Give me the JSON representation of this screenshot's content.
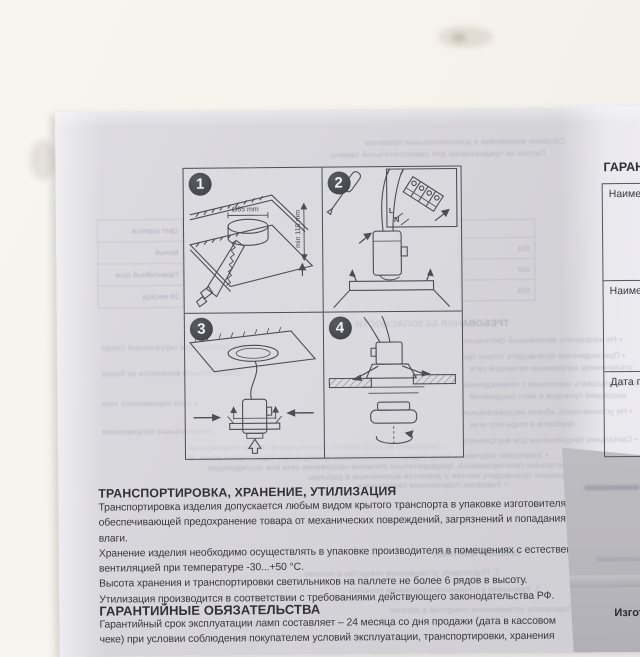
{
  "photo": {
    "transport_section": {
      "title": "ТРАНСПОРТИРОВКА, ХРАНЕНИЕ, УТИЛИЗАЦИЯ",
      "lines": [
        "Транспортировка изделия допускается любым видом крытого транспорта в упаковке изготовителя,",
        "обеспечивающей предохранение товара от механических повреждений, загрязнений и попадания",
        "влаги.",
        "Хранение изделия необходимо осуществлять в упаковке производителя в помещениях с естественной",
        "вентиляцией при температуре -30...+50 °С.",
        "Высота хранения и транспортировки светильников на паллете не более 6 рядов в высоту.",
        "Утилизация производится в соответствии с требованиями действующего законодательства РФ."
      ]
    },
    "warranty_section": {
      "title": "ГАРАНТИЙНЫЕ ОБЯЗАТЕЛЬСТВА",
      "lines": [
        "Гарантийный срок эксплуатации ламп составляет – 24 месяца со дня продажи (дата в кассовом",
        "чеке) при условии соблюдения покупателем условий эксплуатации, транспортировки, хранения"
      ]
    },
    "diagram_steps": {
      "step1": {
        "number": "1",
        "dim_hole": "Ø85 mm",
        "dim_height": "min 110 mm"
      },
      "step2": {
        "number": "2",
        "label_l": "L",
        "label_n": "N"
      },
      "step3": {
        "number": "3"
      },
      "step4": {
        "number": "4"
      }
    },
    "warranty_card": {
      "title": "ГАРАН",
      "row1_label": "Наимен",
      "row2_label": "Наимен",
      "row3_label": "Дата про"
    },
    "under_sheet": {
      "manufacturer_label": "Изгот"
    },
    "showthrough": {
      "top1": "Согласно маркировке и дополнительным правилам",
      "top2": "Патрон не предназначен для самостоятельной замены",
      "left_table": [
        "Цвет корпуса",
        "Белый",
        "Гарантийный срок",
        "24 месяца"
      ],
      "codes": [
        "001",
        "002",
        "003"
      ],
      "safety_title": "ТРЕБОВАНИЯ БЕЗОПАСНОСТИ:",
      "mid": [
        "• Не направлять включенный светильник",
        "• Присоединение производить только при",
        "отключенном напряжении питающей сети",
        "• Не использовать светильник с поврежденной",
        "изоляцией проводов и мест соединений",
        "• Не устанавливать вблизи нагревательных",
        "приборов и открытого огня",
        "• Светильник предназначен для внутреннего"
      ],
      "leftcol": [
        "при температуре окружающей среды",
        "относительной влажности не более",
        "в сети переменного тока",
        "номинальным напряжением"
      ],
      "band": [
        "• Запрещено эксплуатировать светильники в случае повреждения",
        "• Запрещено скручивать жилы медных и алюминиевых проводов при подключении возле. М",
        "на светильник смонтированный, предварительно отключив напряжение сети или последующем",
        "• Запрещено производить монтаж и демонтаж включенным в разъемы",
        "• Заведомо подключение светильника"
      ],
      "body": [
        "ПРАВИЛА МОНТАЖА",
        "1. Подготовить установочное отверстие в потолке",
        "2. Удерживая в сложенном напряжении пружины",
        "3. Подключить установочное отверстие в потолке"
      ]
    }
  }
}
